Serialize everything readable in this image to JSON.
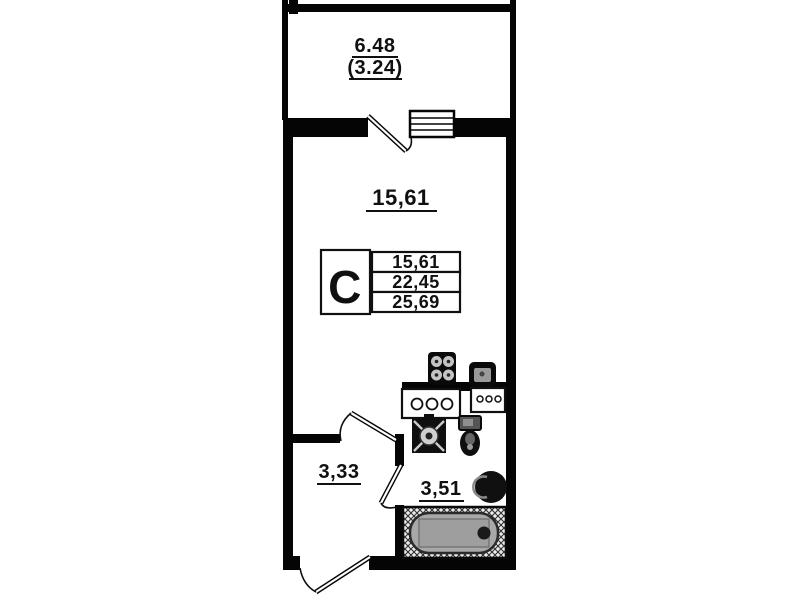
{
  "floor_plan": {
    "balcony": {
      "area": "6.48",
      "area_coefficient": "(3.24)"
    },
    "living_room": {
      "area": "15,61"
    },
    "hallway": {
      "area": "3,33"
    },
    "bathroom": {
      "area": "3,51"
    },
    "info_table": {
      "apartment_type": "С",
      "rows": [
        "15,61",
        "22,45",
        "25,69"
      ]
    },
    "colors": {
      "wall": "#050505",
      "background": "#ffffff",
      "bathtub_fill": "#a8a8a8",
      "label_text": "#101010"
    }
  }
}
